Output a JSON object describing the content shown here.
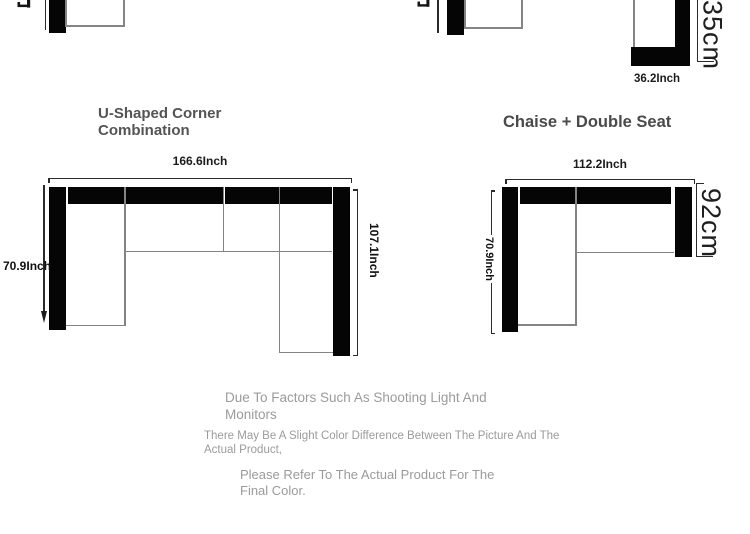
{
  "colors": {
    "frame_black": "#050505",
    "outline_gray": "#848484",
    "dimension_line": "#2b2b2b",
    "dimension_text": "#101010",
    "title_text": "#545454",
    "note_text": "#9b9b9b",
    "background": "#ffffff"
  },
  "top_row": {
    "corner_piece": {
      "width_label": "36.2Inch",
      "depth_label": "35cm"
    }
  },
  "u_shape": {
    "title": "U-Shaped Corner Combination",
    "width_label": "166.6Inch",
    "left_depth_label": "70.9Inch",
    "right_depth_label": "107.1Inch"
  },
  "chaise": {
    "title": "Chaise + Double Seat",
    "width_label": "112.2Inch",
    "left_depth_label": "70.9Inch",
    "right_depth_label": "92cm"
  },
  "notes": {
    "line1": "Due To Factors Such As Shooting Light And Monitors",
    "line2": "There May Be A Slight Color Difference Between The Picture And The Actual Product,",
    "line3": "Please Refer To The Actual Product For The Final Color."
  }
}
